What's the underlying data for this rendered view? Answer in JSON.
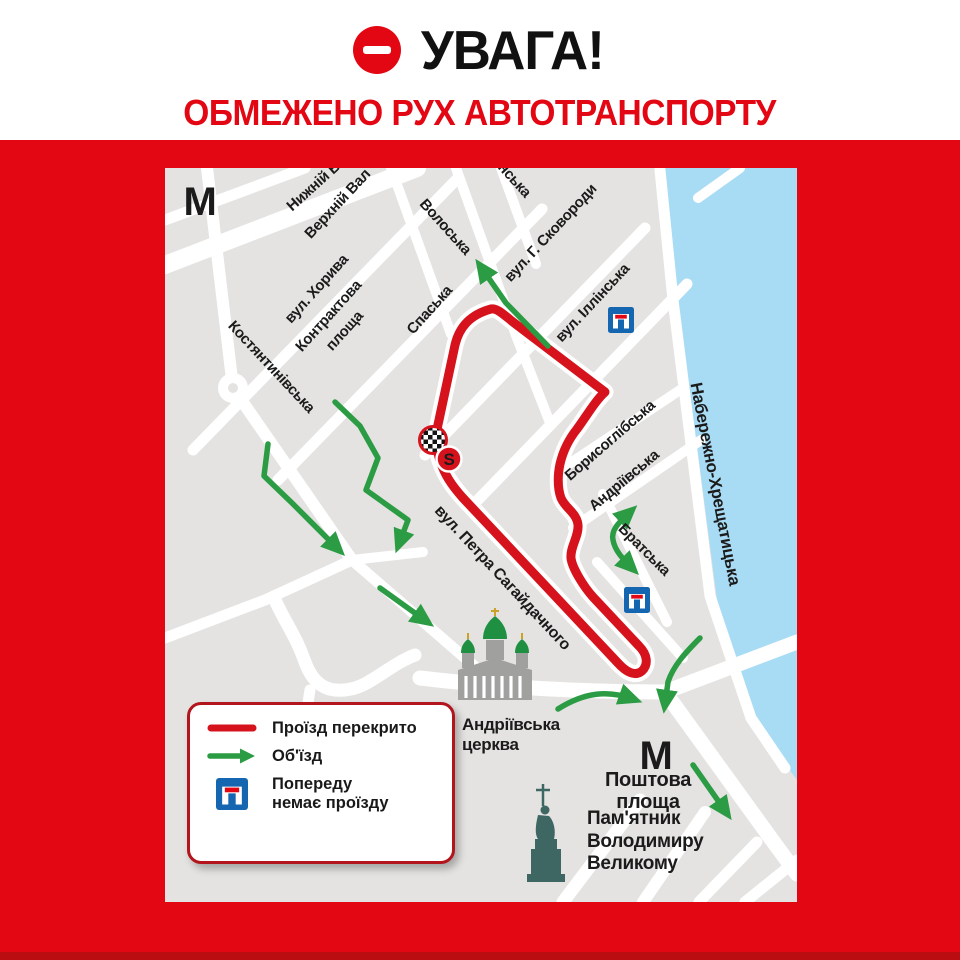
{
  "header": {
    "title": "УВАГА!",
    "subtitle": "ОБМЕЖЕНО РУХ АВТОТРАНСПОРТУ"
  },
  "legend": {
    "closed_label": "Проїзд перекрито",
    "detour_label": "Об'їзд",
    "deadend_line1": "Попереду",
    "deadend_line2": "немає проїзду"
  },
  "map": {
    "streets": {
      "nyzhnii_val": "Нижній Вал",
      "verkhnii_val": "Верхній Вал",
      "voloska": "Волоська",
      "pochaininska_partial": "нська",
      "khoryva": "вул. Хорива",
      "kontraktova_1": "Контрактова",
      "kontraktova_2": "площа",
      "spaska": "Спаська",
      "kostiantynivska": "Костянтинівська",
      "skovorody": "вул. Г. Сковороди",
      "illinska": "вул. Іллінська",
      "borysohlibska": "Борисоглібська",
      "andriivska": "Андріївська",
      "bratska": "Братська",
      "sahaidachnoho": "вул. Петра Сагайдачного",
      "naberezhno": "Набережно-Хрещатицька"
    },
    "pois": {
      "church_1": "Андріївська",
      "church_2": "церква",
      "poshtova_1": "Поштова",
      "poshtova_2": "площа",
      "monument_1": "Пам'ятник",
      "monument_2": "Володимиру",
      "monument_3": "Великому",
      "metro_letter_upper": "М",
      "metro_letter_lower": "М",
      "start_marker": "S"
    }
  },
  "colors": {
    "background_red": "#e30613",
    "route_red": "#d6131c",
    "detour_green": "#2c9c44",
    "metro_green": "#149a40",
    "deadend_blue": "#1566b0",
    "water_blue": "#a8dbf4",
    "map_grey": "#e4e3e1",
    "monument_teal": "#3e6663"
  }
}
